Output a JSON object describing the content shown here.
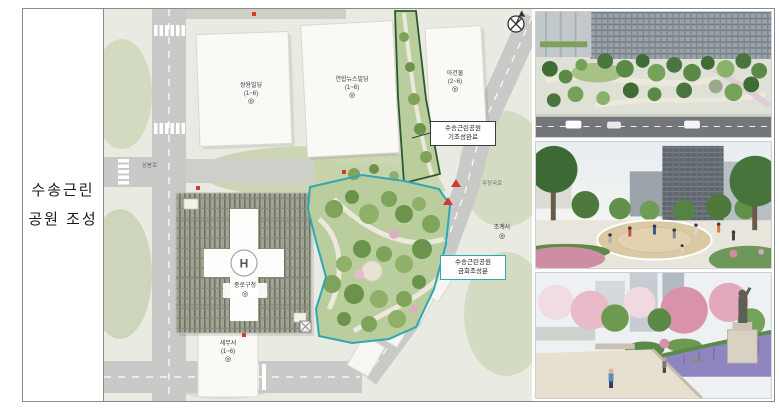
{
  "row_label": {
    "line1": "수송근린",
    "line2": "공원 조성"
  },
  "map": {
    "helipad_letter": "H",
    "callouts": {
      "completed": {
        "line1": "수송근린공원",
        "line2": "기조성완료"
      },
      "current": {
        "line1": "수송근린공원",
        "line2": "금회조성분"
      }
    },
    "buildings": [
      {
        "name": "쌍용빌딩",
        "floors": "(1~6)"
      },
      {
        "name": "연합뉴스빌딩",
        "floors": "(1~6)"
      },
      {
        "name": "아건물",
        "floors": "(2~6)"
      },
      {
        "name": "조계사",
        "floors": ""
      },
      {
        "name": "종로구청",
        "floors": ""
      },
      {
        "name": "세무서",
        "floors": "(1~6)"
      }
    ],
    "road_labels": [
      {
        "text": "삼봉로"
      },
      {
        "text": "우정국로"
      }
    ],
    "legend_colors": {
      "completed_outline": "#2c5a30",
      "current_outline": "#2fa7b4",
      "park_green": "#b9ce9c",
      "marker_red": "#d23a2a"
    }
  },
  "icons": {
    "building_marker": "◎"
  },
  "photo_accent_colors": {
    "lavender": "#8f86c0",
    "blossom_pink": "#d893aa",
    "tree_green": "#5c8a46"
  }
}
